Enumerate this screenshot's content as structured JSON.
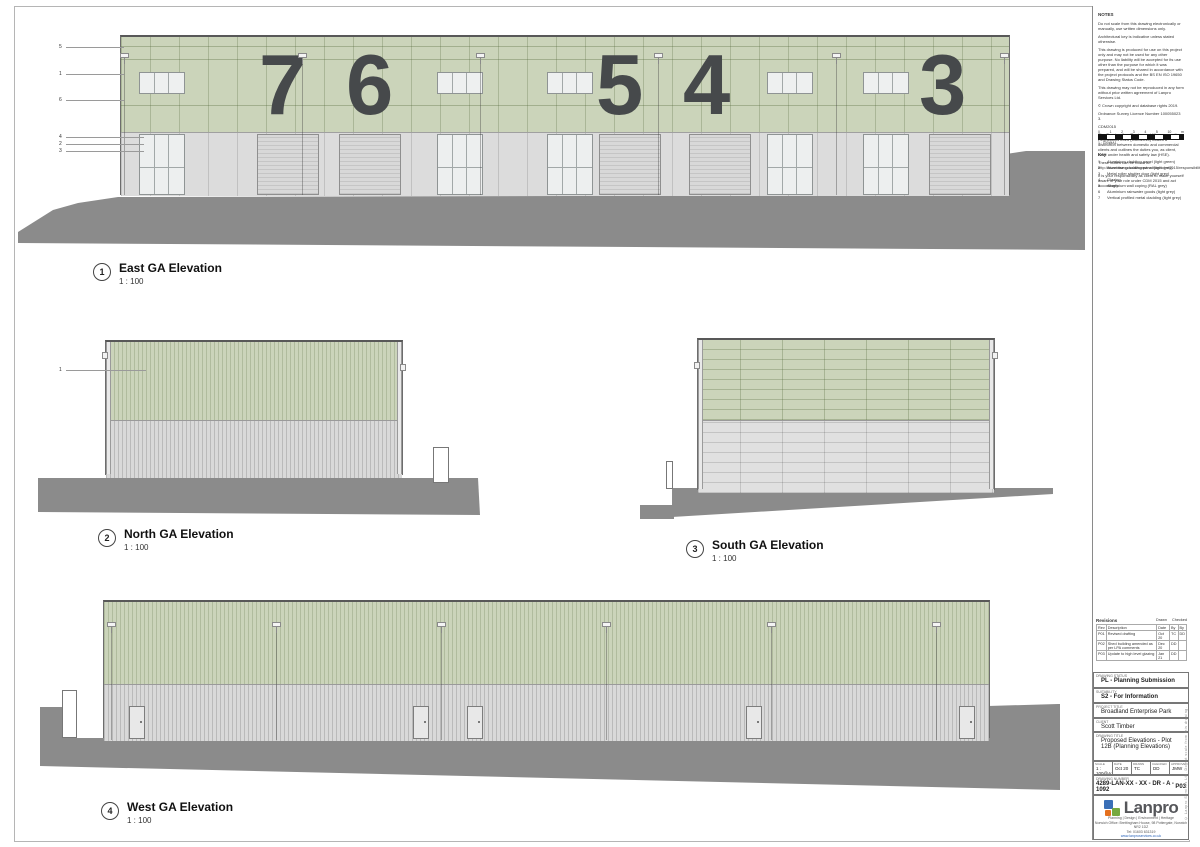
{
  "elevations": [
    {
      "ref": "1",
      "title": "East GA Elevation",
      "scale": "1 : 100"
    },
    {
      "ref": "2",
      "title": "North GA Elevation",
      "scale": "1 : 100"
    },
    {
      "ref": "3",
      "title": "South GA Elevation",
      "scale": "1 : 100"
    },
    {
      "ref": "4",
      "title": "West GA Elevation",
      "scale": "1 : 100"
    }
  ],
  "east": {
    "unit_numbers": [
      "7",
      "6",
      "5",
      "4",
      "3"
    ],
    "keynotes_top": [
      "5",
      "1",
      "6"
    ],
    "keynotes_bottom": [
      "4",
      "2",
      "3"
    ]
  },
  "north": {
    "keynote": "1"
  },
  "notes": {
    "heading": "NOTES",
    "paragraphs": [
      "Do not scale from this drawing electronically or manually, use written dimensions only.",
      "Architectural key is indicative unless stated otherwise.",
      "This drawing is produced for use on this project only and may not be used for any other purpose. No liability will be accepted for its use other than the purpose for which it was prepared, and will be shared in accordance with the project protocols and the BS EN ISO 19650 and Drawing Status Code.",
      "This drawing may not be reproduced in any form without prior written agreement of Lanpro Services Ltd.",
      "© Crown copyright and database rights 2019.",
      "Ordnance Survey Licence Number 100055023 3.",
      "CDM2015",
      "The Construction (Design and Management) Regulations 2015 (CDM2015) makes a distinction between domestic and commercial clients and outlines the duties you, as client, have under health and safety law (HSE).",
      "These duties can be found at: http://www.hse.gov.uk/construction/cdm/2015/responsibilities.htm",
      "It is your responsibility as client to make yourself aware of your role under CDM 2015 and act accordingly."
    ]
  },
  "scale_bar": {
    "labels": [
      "0",
      "1",
      "2",
      "3",
      "4",
      "5",
      "10"
    ],
    "unit": "m",
    "caption": "1 : 100@A1"
  },
  "key": {
    "heading": "Key",
    "items": [
      {
        "ref": "1",
        "label": "Aluminium cladding panel (light green)"
      },
      {
        "ref": "2",
        "label": "Aluminium cladding panel (light grey)"
      },
      {
        "ref": "3",
        "label": "Metal roller shutter door (light grey)"
      },
      {
        "ref": "4",
        "label": "Glazing"
      },
      {
        "ref": "5",
        "label": "Aluminium wall coping (RAL grey)"
      },
      {
        "ref": "6",
        "label": "Aluminium rainwater goods (light grey)"
      },
      {
        "ref": "7",
        "label": "Vertical profiled metal cladding (light grey)"
      }
    ]
  },
  "revisions": {
    "heading": "Revisions",
    "drawn_label": "Drawn",
    "checked_label": "Checked",
    "columns": [
      "Rev",
      "Description",
      "Date",
      "By",
      "By"
    ],
    "rows": [
      {
        "rev": "P01",
        "description": "Revised drafting",
        "date": "Oct 20",
        "drawn": "TC",
        "checked": "DD"
      },
      {
        "rev": "P02",
        "description": "Shed building amended as per LPA comments",
        "date": "Dec 20",
        "drawn": "DD",
        "checked": ""
      },
      {
        "rev": "P03",
        "description": "Update to high level glazing",
        "date": "Jan 21",
        "drawn": "DD",
        "checked": ""
      }
    ]
  },
  "title_block": {
    "status_label": "DRAWING STATUS",
    "status": "PL - Planning Submission",
    "suitability_label": "SUITABILITY",
    "suitability": "S2 - For Information",
    "project_label": "PROJECT TITLE",
    "project": "Broadland Enterprise Park",
    "client_label": "CLIENT",
    "client": "Scott Timber",
    "drawing_title_label": "DRAWING TITLE",
    "drawing_title": "Proposed Elevations - Plot 12B (Planning Elevations)",
    "fields": [
      {
        "label": "SCALE",
        "value": "1 : 100@A1"
      },
      {
        "label": "DATE",
        "value": "Oct 20"
      },
      {
        "label": "DRAWN",
        "value": "TC"
      },
      {
        "label": "CHECKED",
        "value": "DD"
      },
      {
        "label": "APPROVED",
        "value": "JMW"
      }
    ],
    "drawing_number_label": "DRAWING NUMBER",
    "drawing_number": "4289-LAN-XX - XX - DR - A - 1092",
    "revision": "P03",
    "side_note": "© Lanpro Services Ltd. Do not scale from this drawing."
  },
  "brand": {
    "name": "Lanpro",
    "tagline": "Planning | Design | Environment | Heritage",
    "address": "Norwich Office: Brettingham House, 98 Pottergate, Norwich NR2 1DZ",
    "phone": "Tel: 01603 631319",
    "website": "www.lanproservices.co.uk"
  },
  "colors": {
    "cladding_green": "#cbd4ba",
    "cladding_grey": "#dcdcdc",
    "ground_grey": "#8b8b8b",
    "unit_number": "#46494b",
    "logo_blue": "#3a6fb7",
    "logo_orange": "#e4701e",
    "logo_green": "#76a93f",
    "link_blue": "#2a63b8"
  }
}
